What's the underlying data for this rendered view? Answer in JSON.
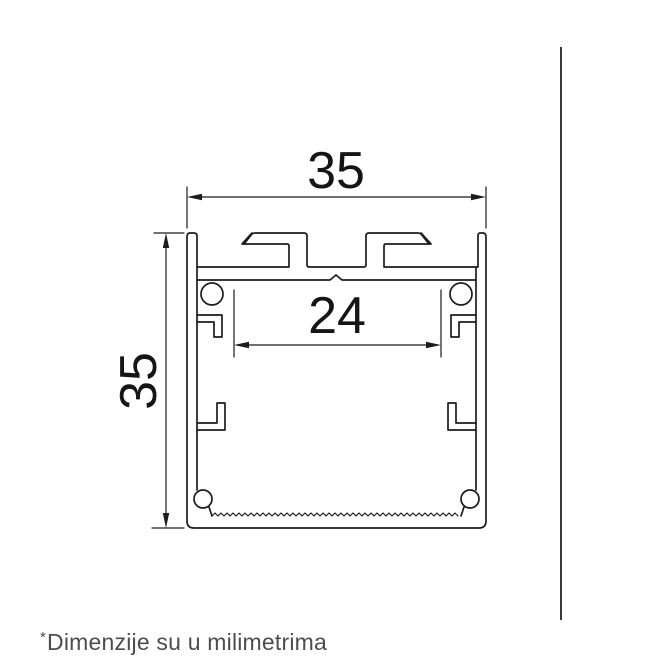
{
  "diagram": {
    "title": "LED aluminium profile cross-section drawing",
    "top_width_label": "35",
    "left_height_label": "35",
    "inner_width_label": "24",
    "units": "mm",
    "line_color": "#1c1c1c",
    "dim_color": "#1c1c1c",
    "text_color": "#151515"
  },
  "separator": {
    "color": "#3a3a3a"
  },
  "footnote": {
    "marker": "*",
    "text": "Dimenzije su u milimetrima",
    "color": "#4d4d4d"
  }
}
